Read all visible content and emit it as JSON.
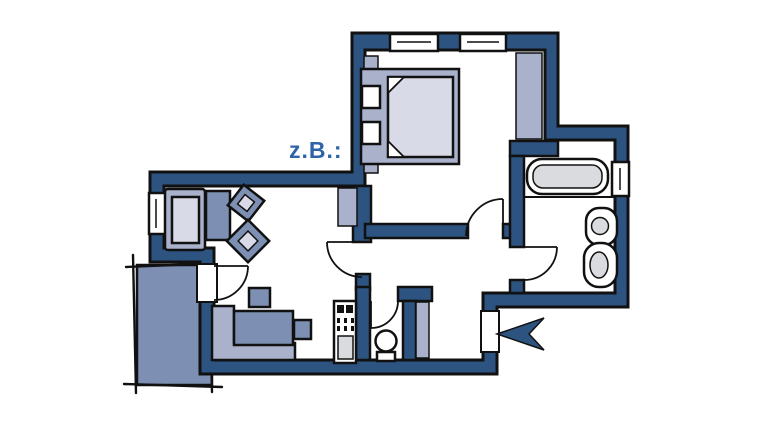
{
  "annotation": {
    "label": "z.B.:"
  },
  "icons": {
    "entrance": "entrance-arrow-icon"
  },
  "colors": {
    "bg": "#ffffff",
    "ink": "#111111",
    "wall": "#2d5381",
    "furnLight": "#a9b1cb",
    "furnMid": "#7d8fb3",
    "mattress": "#d8dae7",
    "inset": "#d9dbdf",
    "text": "#2f64a8"
  }
}
